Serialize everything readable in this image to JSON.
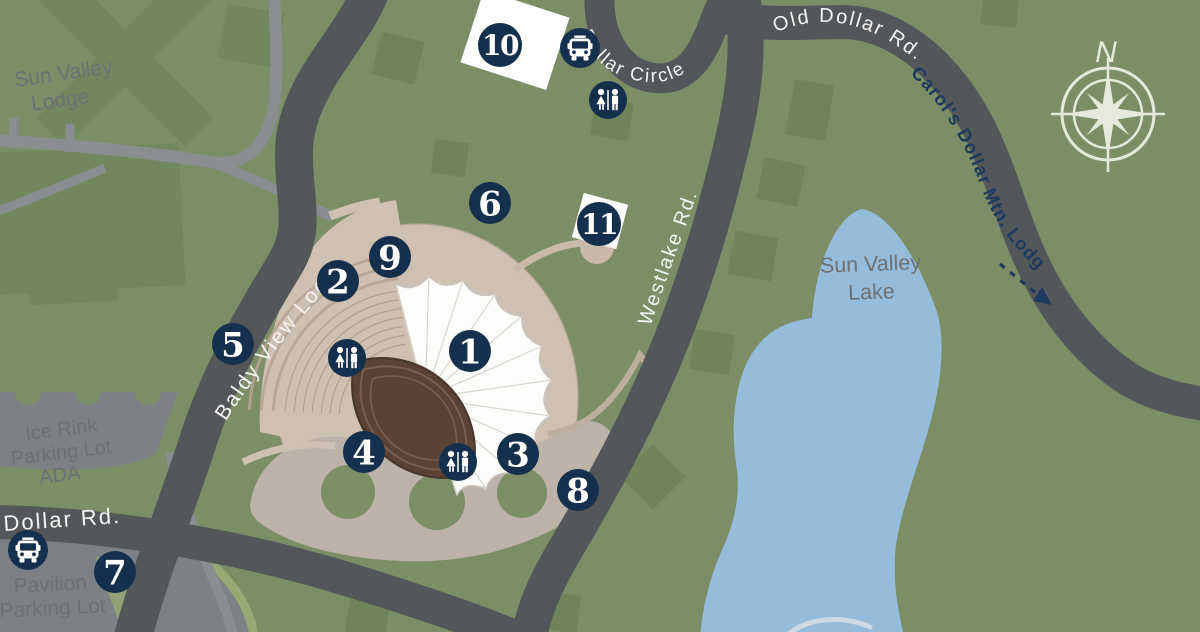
{
  "title": "Sun Valley Pavilion area map",
  "colors": {
    "background_green": "#7b8e66",
    "building_green": "#73875e",
    "tree_green": "#70845a",
    "road_dark": "#54575a",
    "road_minor": "#8a8e91",
    "parking_gray": "#7d8185",
    "median_green": "#97a873",
    "water_blue": "#96bcdb",
    "path_tan": "#cfc1b1",
    "plaza_tan": "#bcb2a8",
    "canopy_white": "#fdfdfb",
    "stage_brown": "#5a4335",
    "marker_navy": "#14304d",
    "compass_pale": "#e7eadb",
    "label_white": "#f4f4f2",
    "label_navy": "#1c3a5e"
  },
  "roads": {
    "baldy_view_loop": {
      "label": "Baldy View Loop"
    },
    "dollar_circle": {
      "label": "Dollar Circle"
    },
    "old_dollar_rd": {
      "label": "Old Dollar Rd."
    },
    "carols_dollar": {
      "label": "Carol's Dollar Mtn. Lodge"
    },
    "westlake_rd": {
      "label": "Westlake Rd."
    },
    "dollar_rd": {
      "label": "Dollar Rd."
    }
  },
  "areas": {
    "sun_valley_lodge": {
      "line1": "Sun Valley",
      "line2": "Lodge"
    },
    "ice_rink_lot": {
      "line1": "Ice Rink",
      "line2": "Parking Lot",
      "line3": "ADA"
    },
    "pavilion_lot": {
      "line1": "Pavilion",
      "line2": "Parking Lot"
    },
    "sun_valley_lake": {
      "line1": "Sun Valley",
      "line2": "Lake"
    }
  },
  "markers": [
    {
      "label": "1"
    },
    {
      "label": "2"
    },
    {
      "label": "3"
    },
    {
      "label": "4"
    },
    {
      "label": "5"
    },
    {
      "label": "6"
    },
    {
      "label": "7"
    },
    {
      "label": "8"
    },
    {
      "label": "9"
    },
    {
      "label": "10"
    },
    {
      "label": "11"
    }
  ],
  "compass": {
    "north_label": "N"
  },
  "icons": {
    "bus": "bus-icon",
    "restroom": "restroom-icon",
    "compass": "compass-rose",
    "arrow": "direction-arrow"
  }
}
